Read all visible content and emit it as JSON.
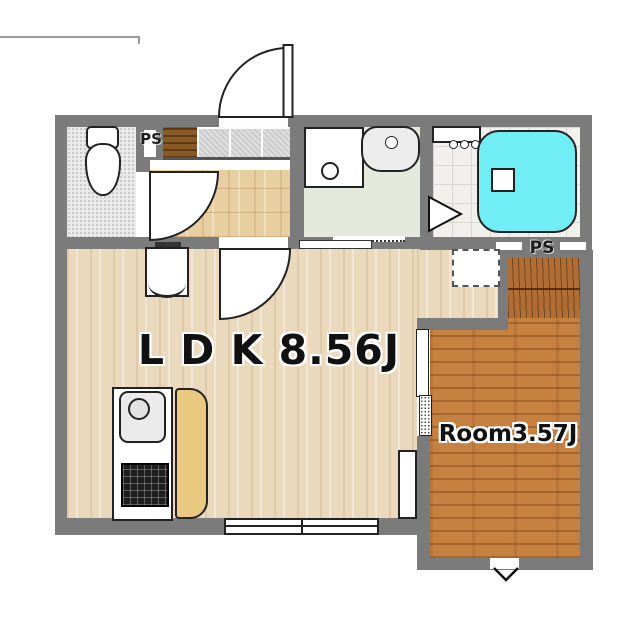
{
  "plan_title": "apartment-floor-plan",
  "labels": {
    "ldk": "L D K 8.56J",
    "room": "Room3.57J",
    "ps_top": "PS",
    "ps_right": "PS"
  },
  "rooms": [
    {
      "name": "LDK",
      "size": "8.56J",
      "floor": "light wood"
    },
    {
      "name": "Room",
      "size": "3.57J",
      "floor": "dark wood"
    },
    {
      "name": "Toilet",
      "floor": "stippled gray"
    },
    {
      "name": "Washroom",
      "floor": "pale green"
    },
    {
      "name": "Bathroom",
      "floor": "white tile"
    },
    {
      "name": "Entrance",
      "floor": "gray tile"
    },
    {
      "name": "Hallway",
      "floor": "wood"
    },
    {
      "name": "Closet",
      "floor": "hatched dark wood"
    }
  ],
  "fixtures": [
    "entrance-door",
    "toilet",
    "toilet-door",
    "shoe-cabinet",
    "pipe-space",
    "washing-machine-pan",
    "wash-basin",
    "washroom-sliding-door",
    "bath-counter",
    "faucet-knobs",
    "bathtub",
    "bath-step",
    "bath-folding-door",
    "ldk-door",
    "refrigerator",
    "kitchen-sink",
    "gas-stove",
    "kitchen-counter",
    "storage-cabinet",
    "air-conditioner",
    "sliding-door",
    "window",
    "floor-vent"
  ],
  "colors": {
    "wall": "#7b7b7b",
    "light_wood": "#ead9bd",
    "hall_wood": "#e8cfa2",
    "dark_wood": "#c6803f",
    "closet_wood": "#b06e35",
    "washroom_floor": "#e3eadd",
    "bathtub": "#71edf5",
    "kitchen_counter": "#e9c87f",
    "shoe_cabinet": "#8a5a26",
    "label_text": "#111111"
  }
}
